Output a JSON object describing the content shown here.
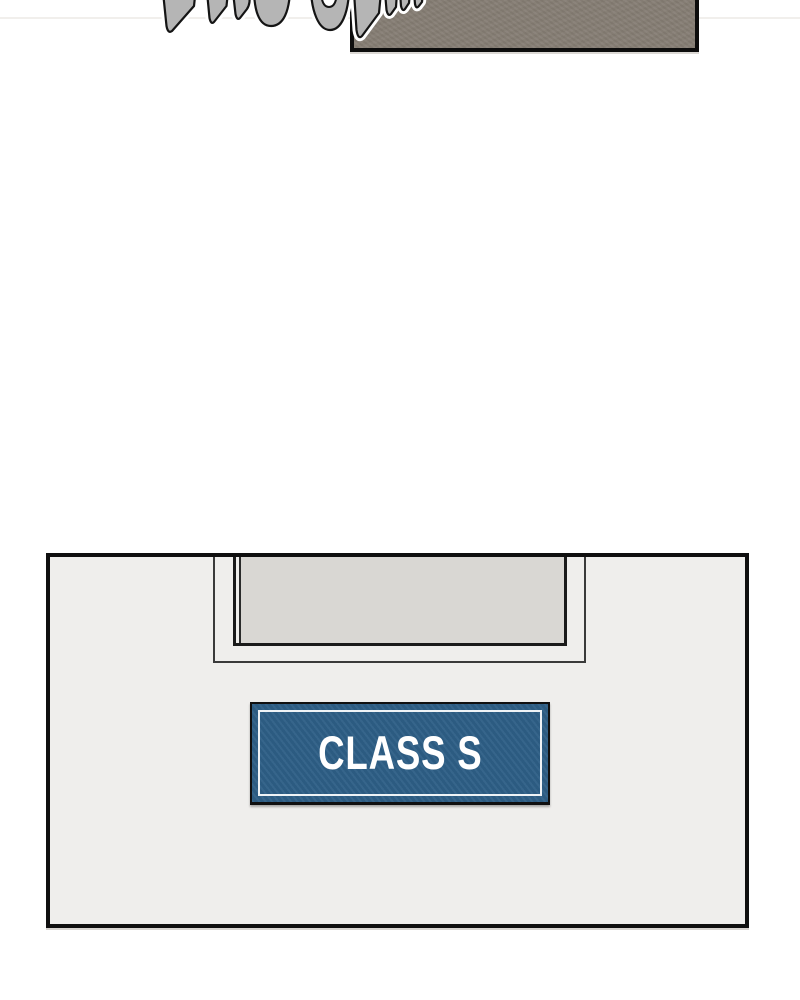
{
  "page": {
    "kind": "webtoon-comic-page-segment",
    "background": "#ffffff"
  },
  "colors": {
    "paper": "#ffffff",
    "ink": "#141414",
    "panel-top-fill": "#867e74",
    "wall": "#efeeec",
    "glass": "#d9d7d3",
    "sign-blue": "#2e5f86",
    "sign-text": "#ffffff",
    "sfx-gray": "#b5b5b5",
    "texture-line": "#f1efec"
  },
  "panel_top": {
    "name": "cropped-taupe-panel",
    "fill": "#867e74",
    "sfx": {
      "name": "sfx-lettering-cropped",
      "description": "bottom fragments of large hand-drawn sound-effect letters, cut off by top edge",
      "fill": "#b5b5b5",
      "outline": "#141414",
      "halo": "#ffffff"
    }
  },
  "panel_bottom": {
    "name": "classroom-door-wall-panel",
    "wall_fill": "#efeeec",
    "window": {
      "name": "door-window",
      "glass_fill": "#d9d7d3"
    },
    "sign": {
      "label": "CLASS S",
      "bg": "#2e5f86",
      "border_inner": "#eef3f6",
      "text_color": "#ffffff"
    }
  }
}
